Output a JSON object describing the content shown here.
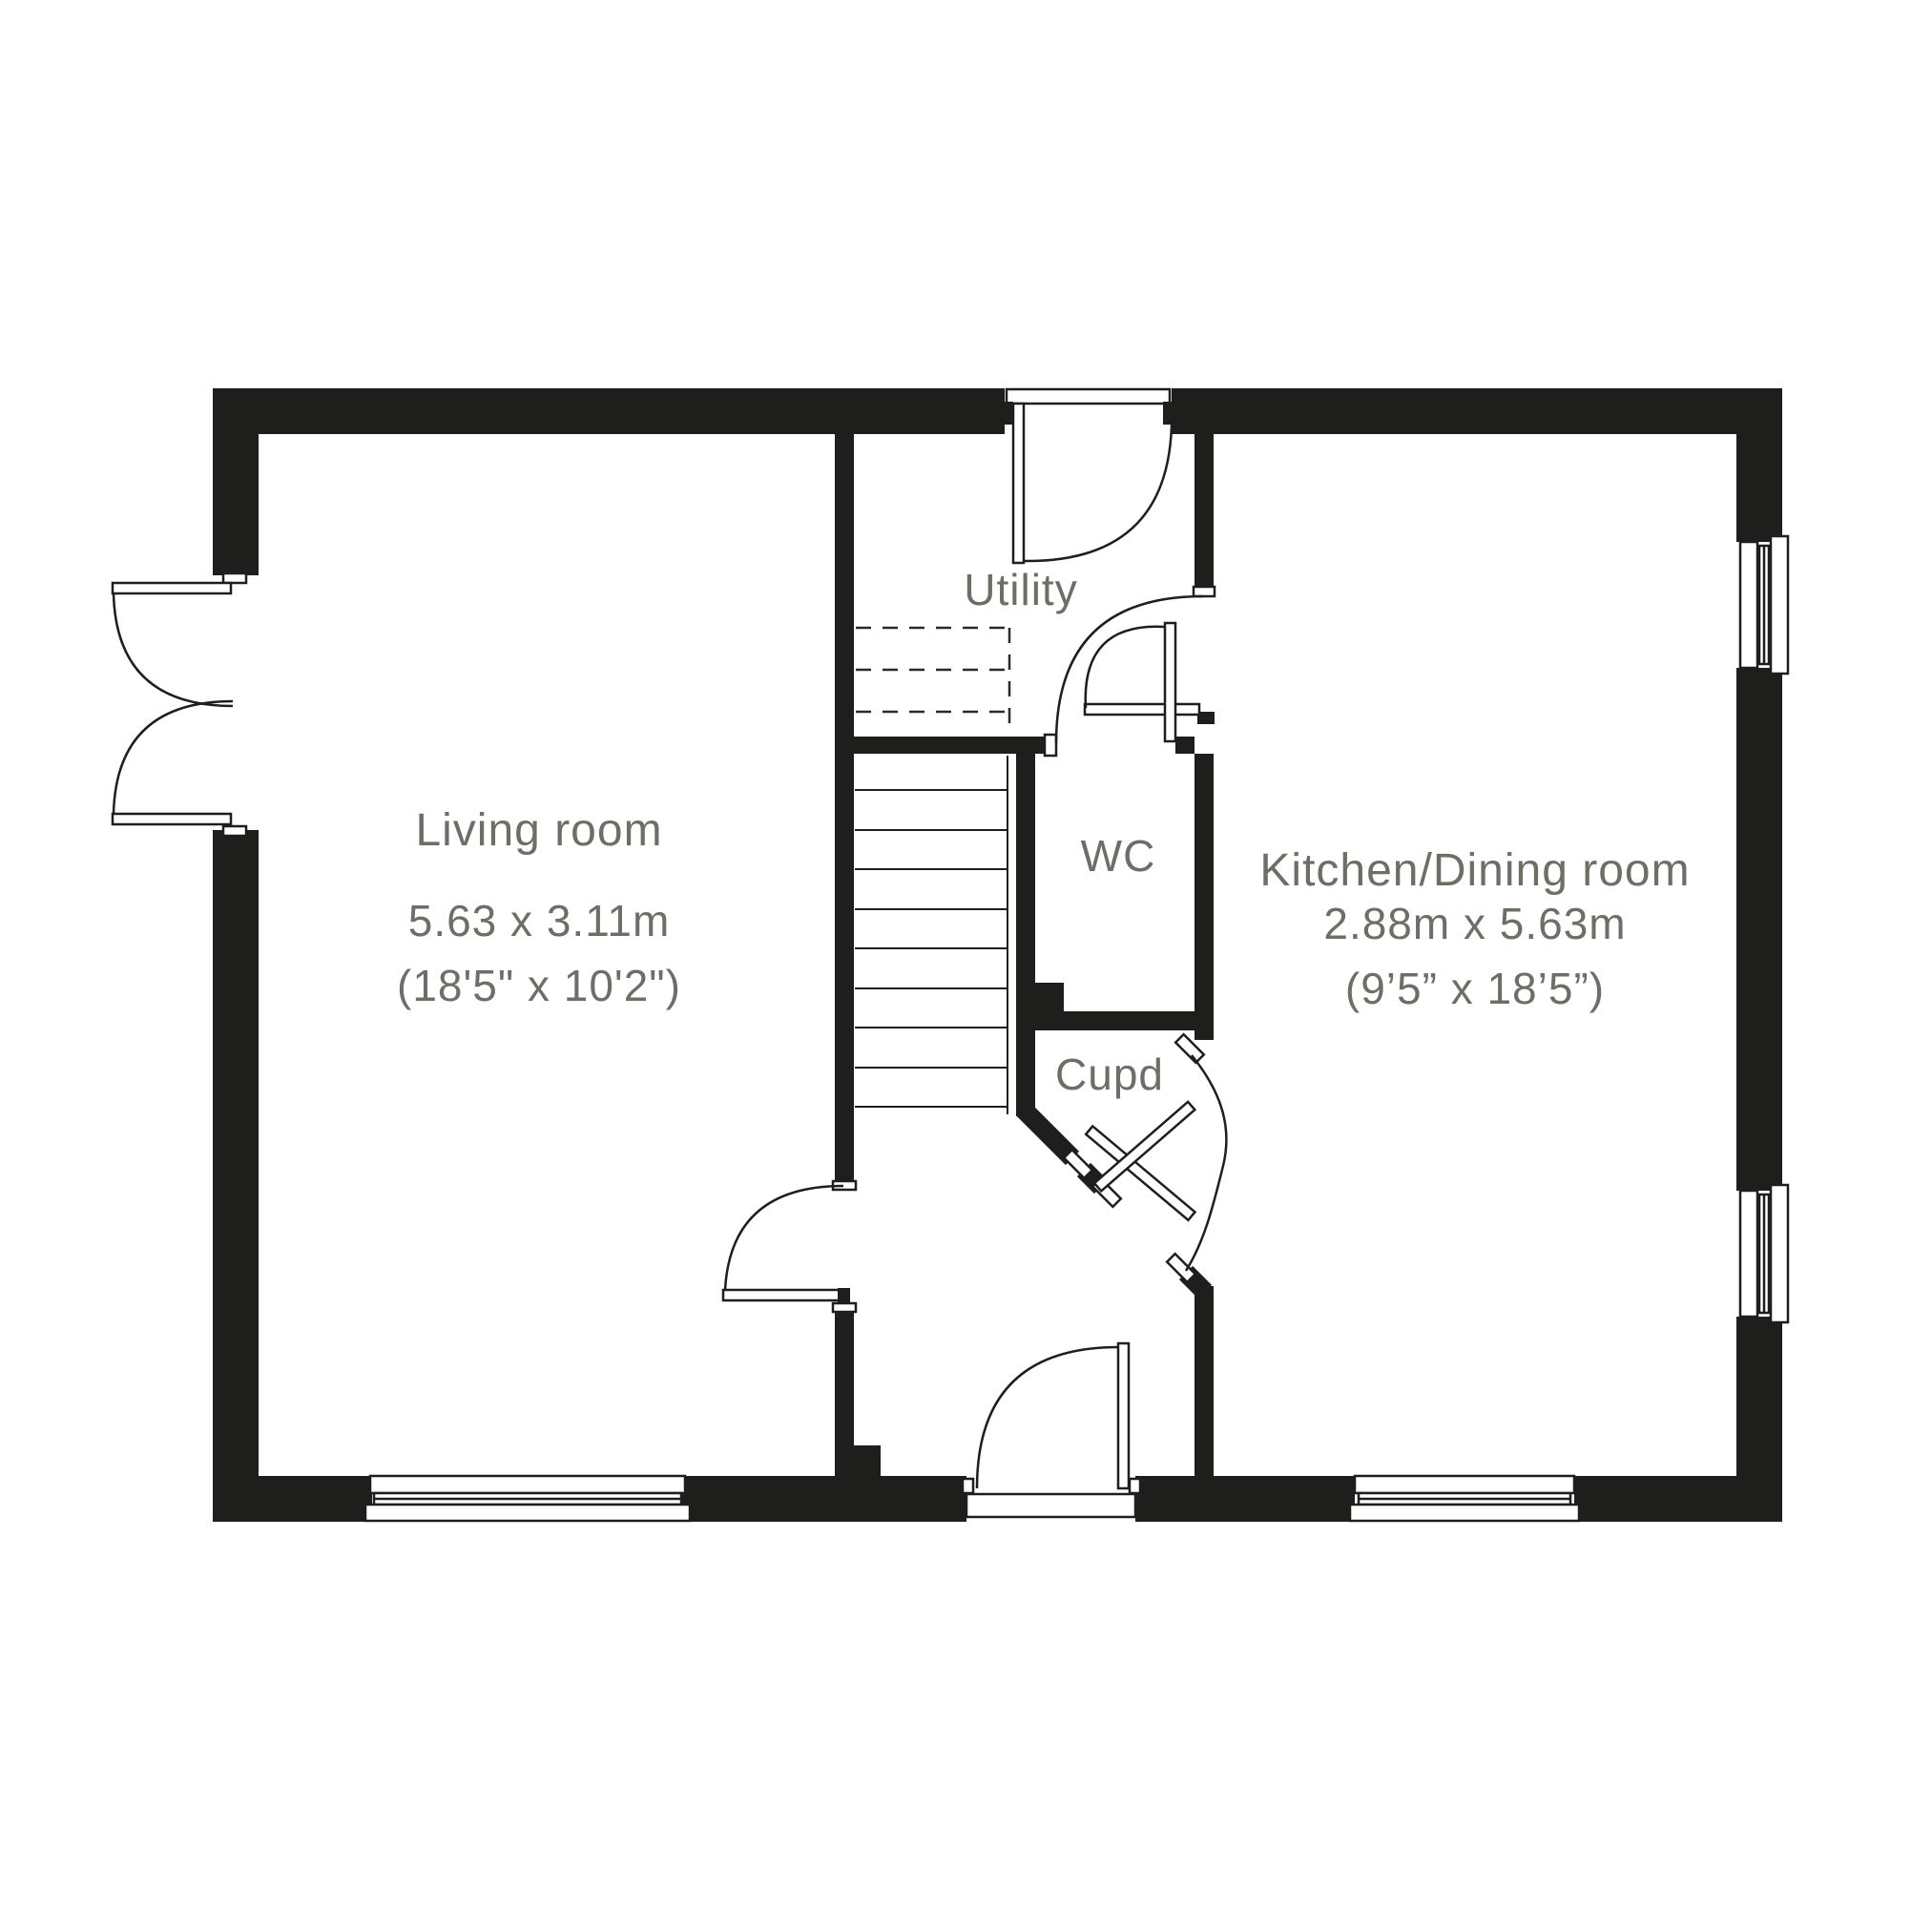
{
  "plan": {
    "colors": {
      "wall": "#1e1e1c",
      "label": "#6f6e66",
      "background": "#ffffff"
    },
    "rooms": {
      "living": {
        "name": "Living room",
        "dim_metric": "5.63 x 3.11m",
        "dim_imperial": "(18'5\" x 10'2\")"
      },
      "kitchen": {
        "name": "Kitchen/Dining room",
        "dim_metric": "2.88m x 5.63m",
        "dim_imperial": "(9’5” x 18’5”)"
      },
      "utility": {
        "name": "Utility"
      },
      "wc": {
        "name": "WC"
      },
      "cupboard": {
        "name": "Cupd"
      }
    }
  }
}
